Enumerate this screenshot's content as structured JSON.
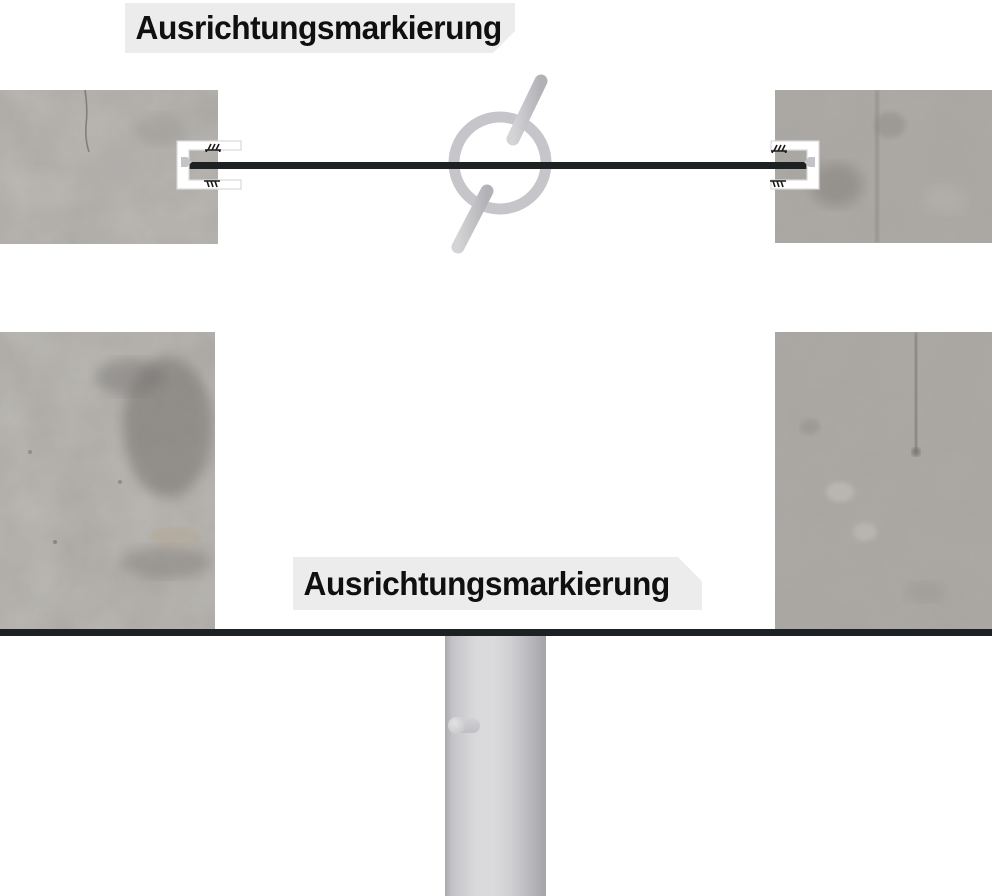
{
  "labels": {
    "top": "Ausrichtungsmarkierung",
    "bottom": "Ausrichtungsmarkierung"
  },
  "colors": {
    "label_bg": "#ececec",
    "label_text": "#101010",
    "line_color": "#1e2124",
    "concrete_base": "#a9a6a2",
    "ring_gray": "#c6c6ca",
    "rod_gray": "#c4c4c8",
    "bracket_white": "#ffffff",
    "bracket_border": "#d9d9d9",
    "pole_light": "#dbdbdd",
    "pole_dark": "#a4a4a8"
  },
  "icons": {
    "marking-tool-icon": "gray ring crossed by tilted cylindrical rod (scribing/marking tool symbol)",
    "clamp-bracket-icon": "white C-shaped clamp holding the alignment line at the concrete edge",
    "scribed-mark-icon": "tiny hatched scratch mark above and below the line ends",
    "arrow-nib-icon": "small gray arrowhead where the line meets the bracket"
  }
}
